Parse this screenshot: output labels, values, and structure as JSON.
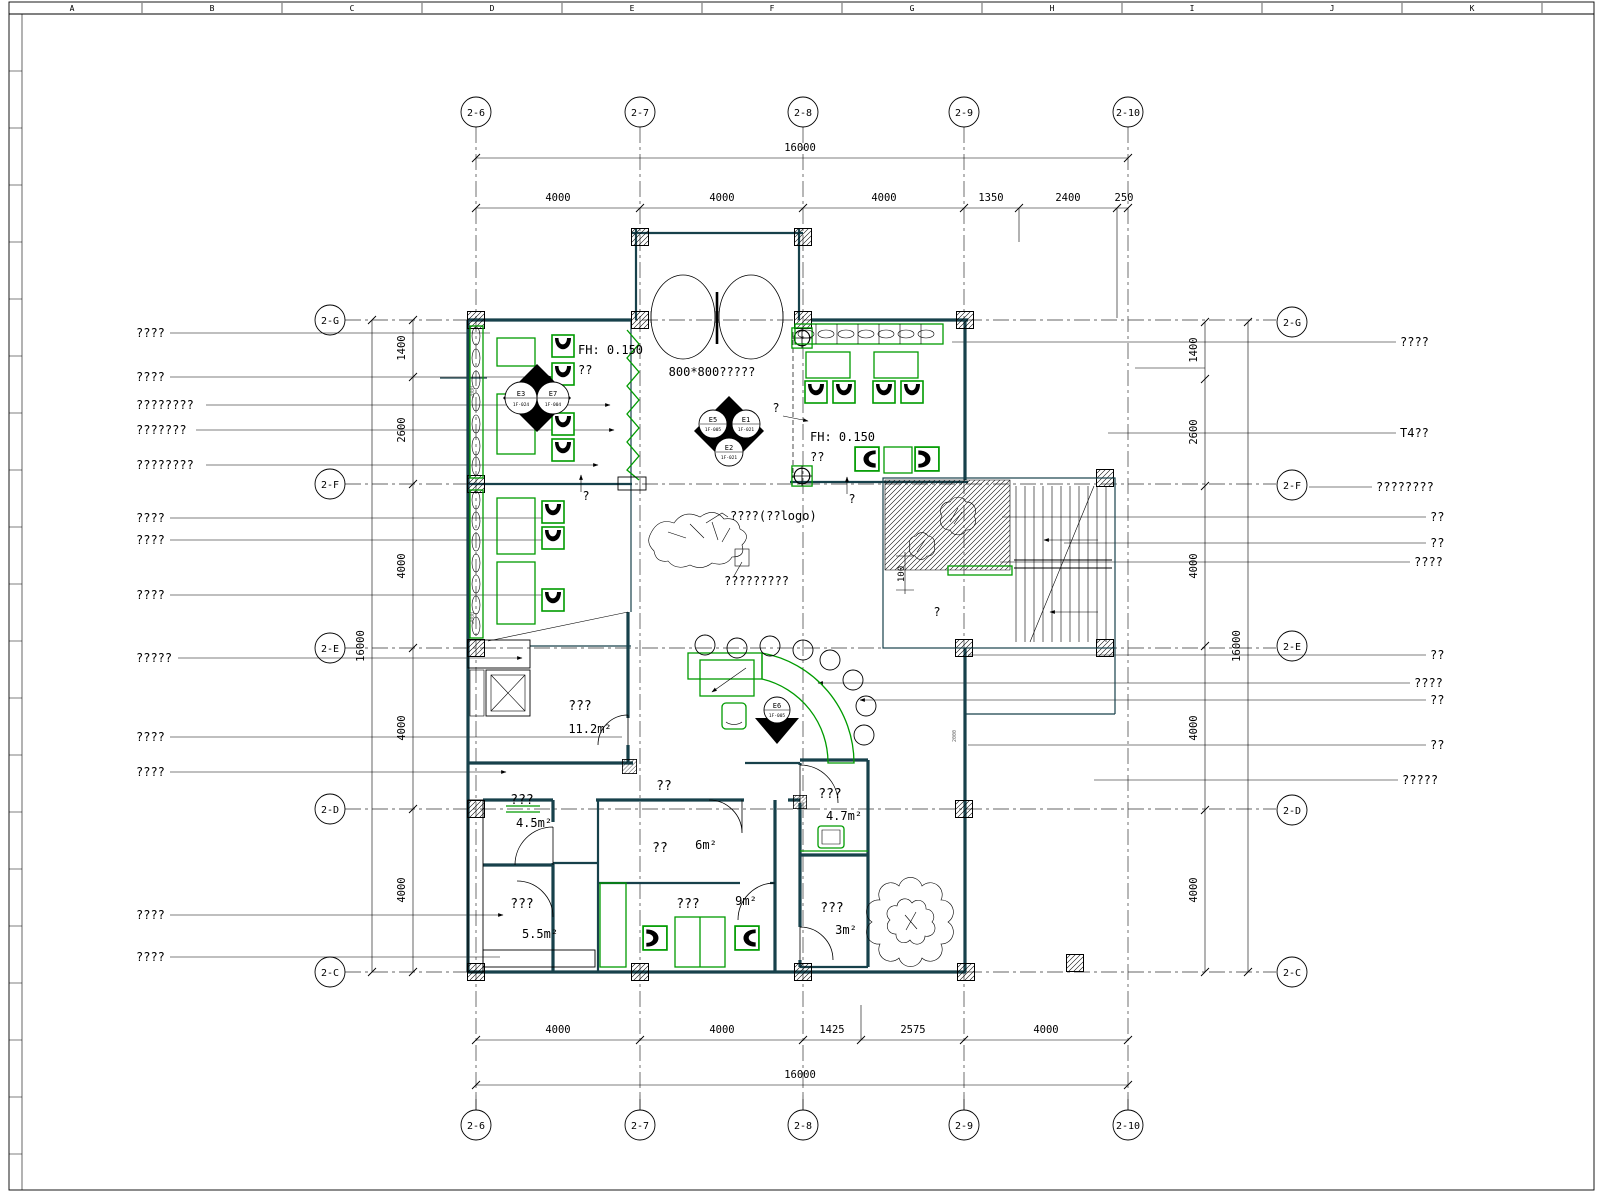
{
  "drawing": {
    "ruler_letters": [
      "A",
      "B",
      "C",
      "D",
      "E",
      "F",
      "G",
      "H",
      "I",
      "J",
      "K"
    ],
    "grid": {
      "vertical_bubbles": [
        "2-6",
        "2-7",
        "2-8",
        "2-9",
        "2-10"
      ],
      "horizontal_bubbles": [
        "2-G",
        "2-F",
        "2-E",
        "2-D",
        "2-C"
      ]
    },
    "dims": {
      "top_overall": "16000",
      "top_segments": [
        "4000",
        "4000",
        "4000",
        "1350",
        "2400",
        "250"
      ],
      "bottom_segments": [
        "4000",
        "4000",
        "1425",
        "2575",
        "4000"
      ],
      "bottom_overall": "16000",
      "left_segments": [
        "1400",
        "2600",
        "4000",
        "4000",
        "4000"
      ],
      "left_overall": "16000",
      "right_segments": [
        "1400",
        "2600",
        "4000",
        "4000",
        "4000"
      ],
      "right_overall": "16000",
      "ramp_height": "100"
    },
    "callouts": {
      "left": [
        "????",
        "????",
        "????????",
        "???????",
        "????????",
        "????",
        "????",
        "????",
        "?????",
        "????",
        "????",
        "????",
        "????"
      ],
      "right": [
        "????",
        "T4??",
        "????????",
        "??",
        "??",
        "????",
        "??",
        "????",
        "??",
        "??",
        "?????"
      ]
    },
    "labels": {
      "entrance": "800*800?????",
      "fh1": "FH: 0.150",
      "fh1b": "??",
      "fh2": "FH: 0.150",
      "fh2b": "??",
      "logo": "????(??logo)",
      "logo_sub": "?????????",
      "q": "?",
      "corridor": "??",
      "wall_note": "2000"
    },
    "rooms": [
      {
        "name": "???",
        "area": "11.2m²"
      },
      {
        "name": "???",
        "area": "4.5m²"
      },
      {
        "name": "???",
        "area": "5.5m²"
      },
      {
        "name": "??",
        "area": "6m²"
      },
      {
        "name": "???",
        "area": "9m²"
      },
      {
        "name": "???",
        "area": "4.7m²"
      },
      {
        "name": "???",
        "area": "3m²"
      }
    ],
    "markers": [
      {
        "id": "E3",
        "code": "1F-024"
      },
      {
        "id": "E7",
        "code": "1F-004"
      },
      {
        "id": "E5",
        "code": "1F-005"
      },
      {
        "id": "E1",
        "code": "1F-021"
      },
      {
        "id": "E2",
        "code": "1F-021"
      },
      {
        "id": "E6",
        "code": "1F-005"
      }
    ]
  }
}
